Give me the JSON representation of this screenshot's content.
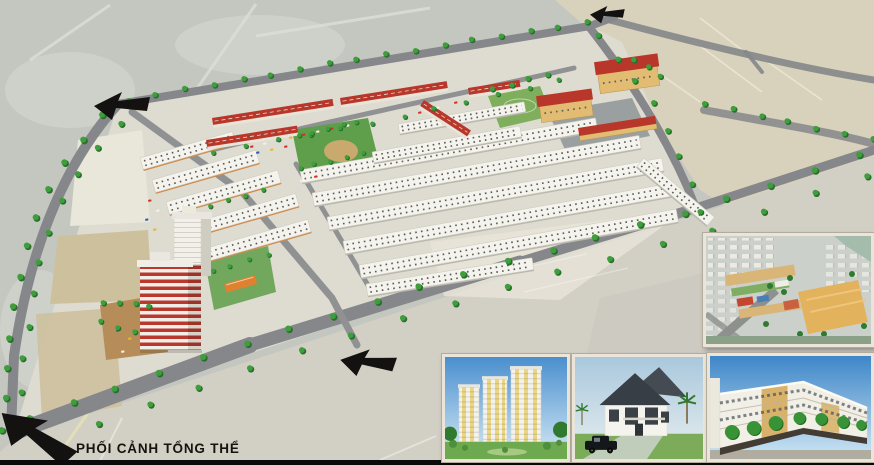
{
  "scene": {
    "caption": "PHỐI CẢNH TỔNG THỂ",
    "colors": {
      "terrain": "#c4c6c0",
      "open_land": "#d8d2bd",
      "site_ground": "#dedbd0",
      "road": "#85878a",
      "road_minor": "#8f9193",
      "highway": "#d2cfc5",
      "tree": "#3f9e3c",
      "tree_dark": "#27702a",
      "white_roof": "#f4f3ed",
      "red_roof": "#b8372a",
      "orange_wall": "#cf8b4a",
      "gray_wall": "#b9b6ac",
      "school_yellow": "#e2bc72",
      "courtyard": "#9aa0a0",
      "park_green": "#5f9e4a",
      "field_green": "#7fae5d",
      "sand": "#c9a96e",
      "tan_parcel": "#cdc09d",
      "cream_parcel": "#e9e6da",
      "plaza": "#b68d58",
      "highrise_red": "#b9392e",
      "pool_blue": "#3d9bd6",
      "arrow": "#141210",
      "bottom_bar": "#0b0b0b",
      "caption_color": "#16130f",
      "inset_border": "#eae5d8",
      "sky_top": "#4a8fce",
      "sky_bottom": "#d6eaf6",
      "lawn": "#6da94f",
      "villa_roof": "#383e45"
    },
    "icons": {
      "arrows": [
        "road-entry-arrow-top-left",
        "road-entry-arrow-top-right",
        "road-entry-arrow-bottom-center",
        "road-entry-arrow-bottom-left"
      ],
      "tree": "street-tree-icon"
    }
  }
}
